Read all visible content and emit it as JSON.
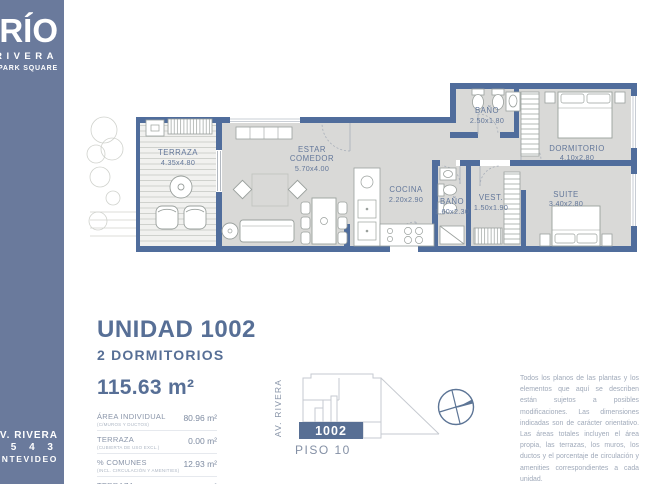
{
  "brand": {
    "name": "BRÍO",
    "sub": "RIVERA",
    "byline": "by PARK SQUARE"
  },
  "address": {
    "street": "AV. RIVERA",
    "number": "2 5 4 3",
    "city": "MONTEVIDEO"
  },
  "colors": {
    "sidebar": "#6a7a9c",
    "walls": "#506d9c",
    "floor": "#d9d9d7",
    "accent": "#576f96"
  },
  "floorplan": {
    "rooms": [
      {
        "line1": "TERRAZA",
        "dims": "4.35x4.80"
      },
      {
        "line1": "ESTAR",
        "line2": "COMEDOR",
        "dims": "5.70x4.00"
      },
      {
        "line1": "COCINA",
        "dims": "2.20x2.90"
      },
      {
        "line1": "BAÑO",
        "dims": "2.50x1.80"
      },
      {
        "line1": "BAÑO",
        "dims": "1.60x2.30"
      },
      {
        "line1": "VEST.",
        "dims": "1.50x1.90"
      },
      {
        "line1": "DORMITORIO",
        "dims": "4.10x2.80"
      },
      {
        "line1": "SUITE",
        "dims": "3.40x2.80"
      }
    ]
  },
  "unit": {
    "title": "UNIDAD 1002",
    "type": "2 DORMITORIOS",
    "total_area": "115.63 m²",
    "specs": [
      {
        "label": "ÁREA INDIVIDUAL",
        "sublabel": "(C/MUROS Y DUCTOS)",
        "value": "80.96 m²"
      },
      {
        "label": "TERRAZA",
        "sublabel": "(CUBIERTA DE USO EXCL.)",
        "value": "0.00 m²"
      },
      {
        "label": "% COMUNES",
        "sublabel": "(INCL. CIRCULACIÓN Y AMENITIES)",
        "value": "12.93 m²"
      },
      {
        "label": "TERRAZA",
        "sublabel": "(DESCUBIERTA DE USO EXCL.)",
        "value": "21.74 m²"
      }
    ]
  },
  "keyplan": {
    "street": "AV. RIVERA",
    "unit": "1002",
    "floor": "PISO 10"
  },
  "disclaimer": "Todos los planos de las plantas y los elementos que aquí se describen están sujetos a posibles modificaciones. Las dimensiones indicadas son de carácter orientativo. Las áreas totales incluyen el área propia, las terrazas, los muros, los ductos y el porcentaje de circulación y amenities correspondientes a cada unidad."
}
